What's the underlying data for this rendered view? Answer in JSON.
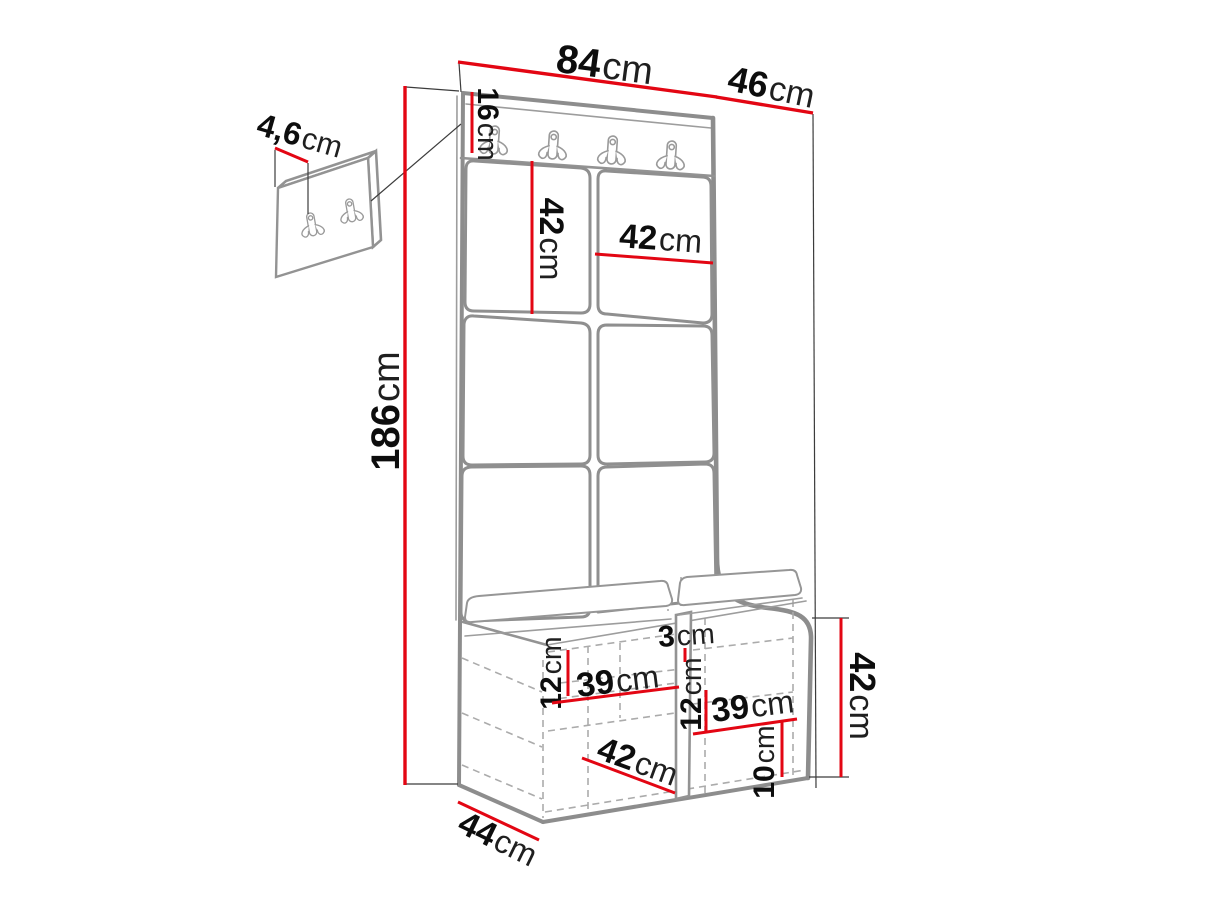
{
  "diagram": {
    "kind": "furniture-dimension-drawing",
    "subject": "hall wardrobe with hook rail, upholstered panels and shoe bench, plus separate two-hook wall panel detail"
  },
  "colors": {
    "dimension_line": "#e30613",
    "furniture_outline": "#8d8d8d",
    "hidden_line": "#ababab",
    "label_text": "#0d0d0d",
    "background": "#ffffff"
  },
  "dims": {
    "width": {
      "value": "84",
      "unit": "cm"
    },
    "depth": {
      "value": "46",
      "unit": "cm"
    },
    "rail_height": {
      "value": "16",
      "unit": "cm"
    },
    "total_height": {
      "value": "186",
      "unit": "cm"
    },
    "hook_panel_thickness": {
      "value": "4,6",
      "unit": "cm"
    },
    "tile_height": {
      "value": "42",
      "unit": "cm"
    },
    "tile_width": {
      "value": "42",
      "unit": "cm"
    },
    "shelf_gap_left": {
      "value": "12",
      "unit": "cm"
    },
    "shelf_width_left": {
      "value": "39",
      "unit": "cm"
    },
    "top_gap": {
      "value": "3",
      "unit": "cm"
    },
    "shelf_gap_right": {
      "value": "12",
      "unit": "cm"
    },
    "shelf_width_right": {
      "value": "39",
      "unit": "cm"
    },
    "plinth_height": {
      "value": "10",
      "unit": "cm"
    },
    "bench_inner_depth": {
      "value": "42",
      "unit": "cm"
    },
    "bench_depth": {
      "value": "44",
      "unit": "cm"
    },
    "bench_height": {
      "value": "42",
      "unit": "cm"
    }
  }
}
